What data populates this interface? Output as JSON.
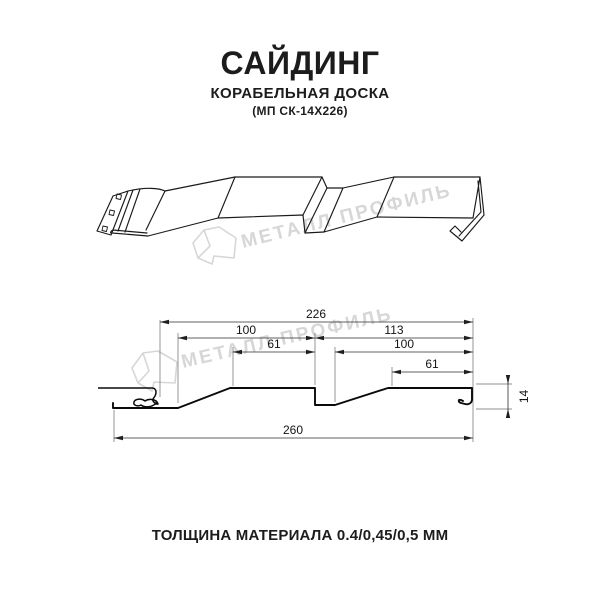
{
  "header": {
    "title": "САЙДИНГ",
    "subtitle": "КОРАБЕЛЬНАЯ ДОСКА",
    "model_code": "(МП СК-14Х226)"
  },
  "watermark": {
    "brand_text": "МЕТАЛЛ ПРОФИЛЬ",
    "color": "#d7d7d7"
  },
  "cross_section": {
    "dimensions": {
      "module": "226",
      "left_panel": "100",
      "left_face": "61",
      "right_panel_outer": "113",
      "right_panel": "100",
      "right_face": "61",
      "overall": "260",
      "depth": "14"
    }
  },
  "footer": {
    "thickness_note": "ТОЛЩИНА МАТЕРИАЛА 0.4/0,45/0,5 ММ"
  },
  "colors": {
    "line": "#1a1a1a",
    "text": "#1c1c1c",
    "watermark": "#d7d7d7",
    "background": "#ffffff"
  }
}
